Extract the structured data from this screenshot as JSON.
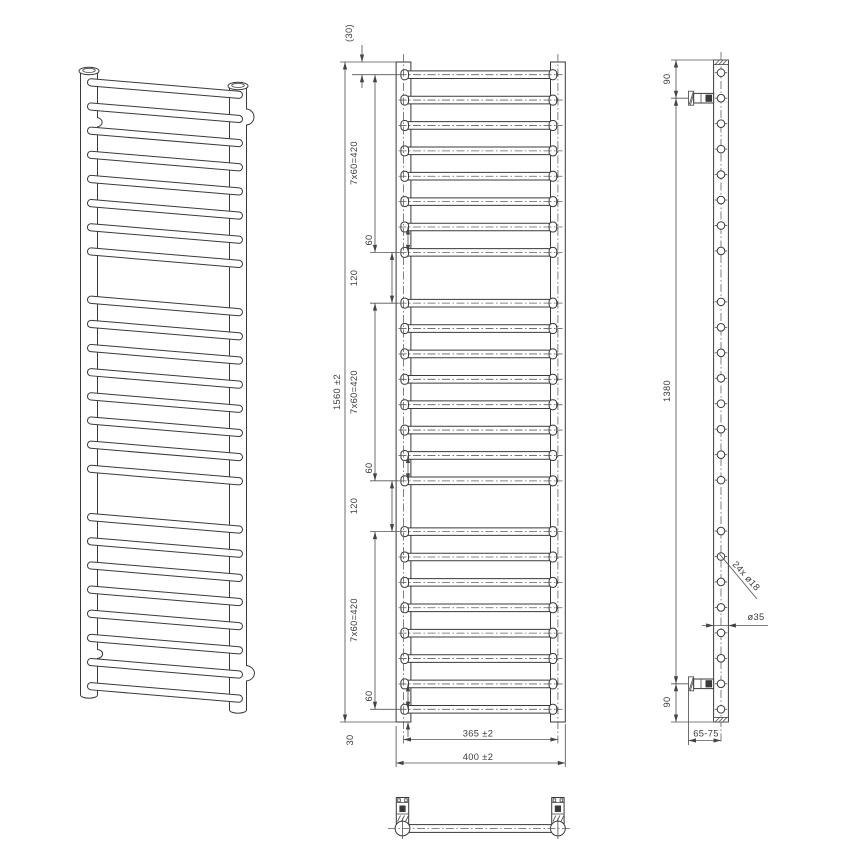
{
  "drawing": {
    "type": "technical-drawing",
    "product": "ladder towel radiator",
    "background": "#ffffff",
    "line_color": "#3a3a3a",
    "dim_color": "#555555",
    "front": {
      "dim_top_offset": "(30)",
      "dim_total_height": "1560 ±2",
      "dim_group_pitch": "7x60=420",
      "dim_rung_gap": "60",
      "dim_group_gap": "120",
      "dim_bottom_offset": "30",
      "dim_axis_width": "365 ±2",
      "dim_overall_width": "400 ±2"
    },
    "side": {
      "dim_bracket_top": "90",
      "dim_bracket_span": "1380",
      "dim_bracket_bottom": "90",
      "dim_bracket_depth": "65-75",
      "dim_rungs": "24x ø18",
      "dim_post": "ø35"
    },
    "structure": {
      "height_mm": 1560,
      "width_mm": 400,
      "axis_width_mm": 365,
      "rung_count": 24,
      "groups": 3,
      "rungs_per_group": 8,
      "rung_pitch_mm": 60,
      "group_gap_mm": 120,
      "top_offset_mm": 30,
      "bottom_offset_mm": 30,
      "rung_diameter_mm": 18,
      "post_diameter_mm": 35,
      "bracket_span_mm": 1380,
      "bracket_end_offset_mm": 90,
      "bracket_depth_mm": "65-75"
    }
  }
}
